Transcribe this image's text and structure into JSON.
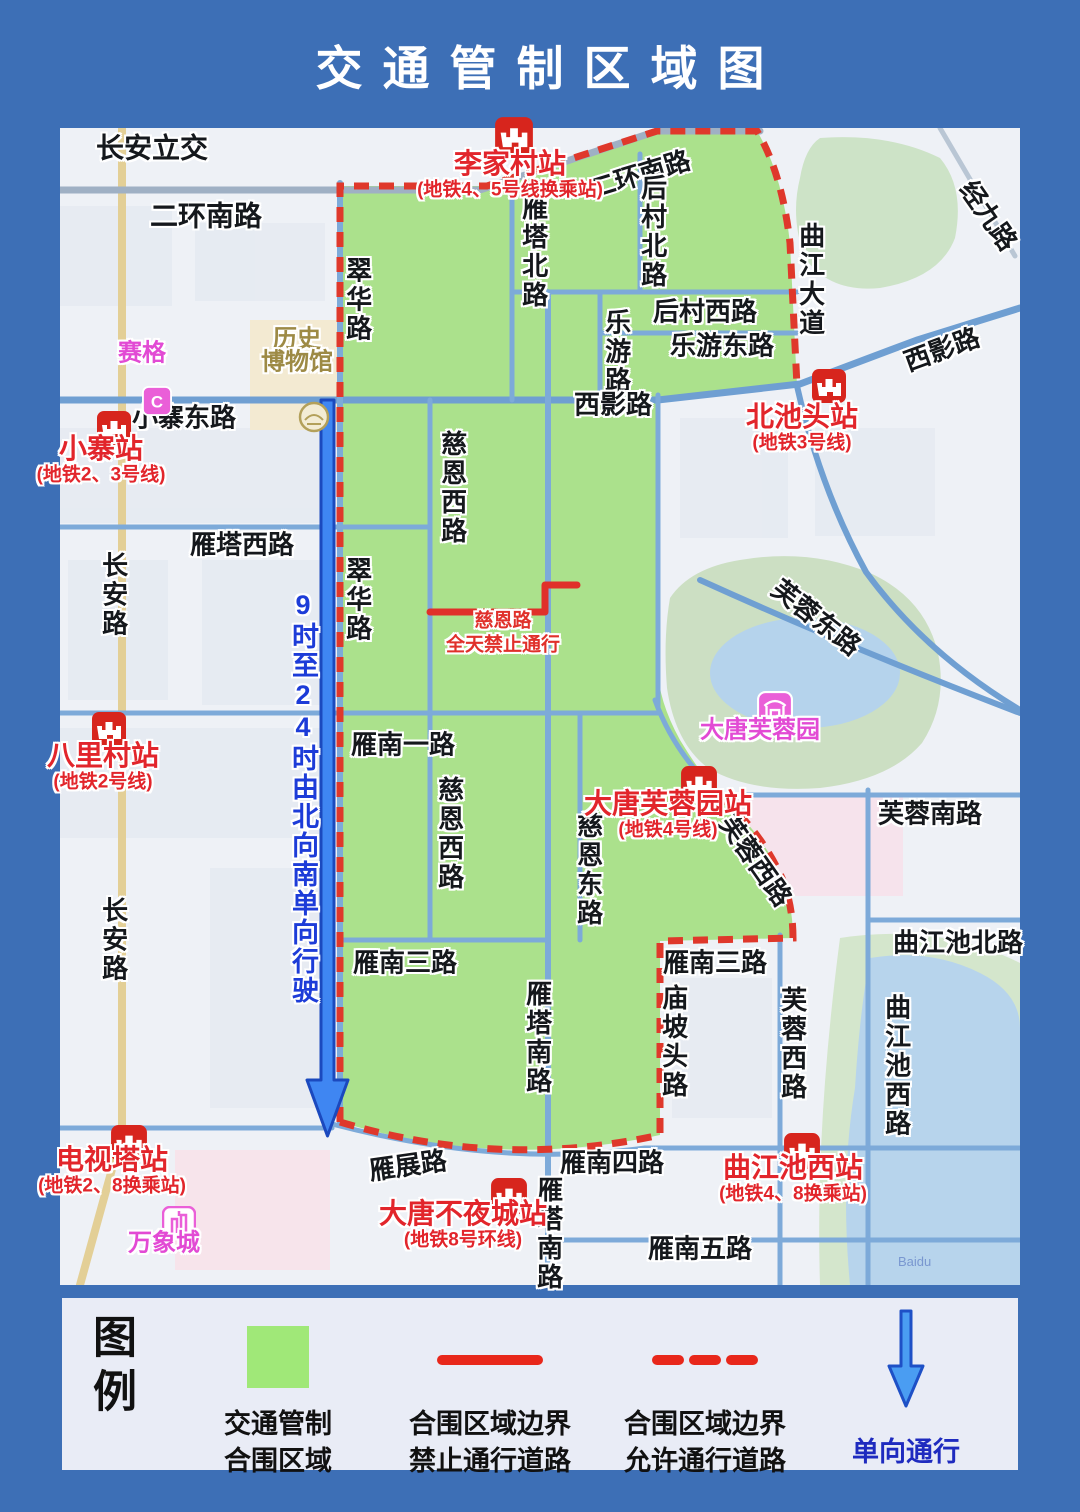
{
  "title": "交通管制区域图",
  "map": {
    "oneway_text": "9时至24时由北向南单向行驶",
    "restriction_note": {
      "line1": "慈恩路",
      "line2": "全天禁止通行"
    },
    "watermark": "Baidu",
    "road_labels": [
      {
        "text": "长安立交",
        "x": 92,
        "y": 20,
        "o": "h",
        "s": 28
      },
      {
        "text": "二环南路",
        "x": 146,
        "y": 88,
        "o": "h",
        "s": 28
      },
      {
        "text": "二环南路",
        "x": 580,
        "y": 47,
        "o": "h",
        "r": -17
      },
      {
        "text": "经九路",
        "x": 928,
        "y": 88,
        "o": "h",
        "r": 55
      },
      {
        "text": "曲江大道",
        "x": 750,
        "y": 152,
        "o": "v"
      },
      {
        "text": "翠华路",
        "x": 297,
        "y": 172,
        "o": "v"
      },
      {
        "text": "雁塔北路",
        "x": 473,
        "y": 124,
        "o": "v"
      },
      {
        "text": "后村北路",
        "x": 592,
        "y": 104,
        "o": "v"
      },
      {
        "text": "后村西路",
        "x": 645,
        "y": 184,
        "o": "h"
      },
      {
        "text": "乐游路",
        "x": 556,
        "y": 224,
        "o": "v"
      },
      {
        "text": "乐游东路",
        "x": 662,
        "y": 218,
        "o": "h"
      },
      {
        "text": "西影路",
        "x": 553,
        "y": 277,
        "o": "h"
      },
      {
        "text": "西影路",
        "x": 882,
        "y": 222,
        "o": "h",
        "r": -20
      },
      {
        "text": "小寨东路",
        "x": 124,
        "y": 290,
        "o": "h"
      },
      {
        "text": "慈恩西路",
        "x": 392,
        "y": 360,
        "o": "v"
      },
      {
        "text": "雁塔西路",
        "x": 182,
        "y": 417,
        "o": "h"
      },
      {
        "text": "长安路",
        "x": 53,
        "y": 467,
        "o": "v"
      },
      {
        "text": "翠华路",
        "x": 297,
        "y": 472,
        "o": "v"
      },
      {
        "text": "芙蓉东路",
        "x": 756,
        "y": 490,
        "o": "h",
        "r": 38
      },
      {
        "text": "雁南一路",
        "x": 343,
        "y": 617,
        "o": "h"
      },
      {
        "text": "慈恩西路",
        "x": 389,
        "y": 706,
        "o": "v"
      },
      {
        "text": "慈恩东路",
        "x": 528,
        "y": 742,
        "o": "v"
      },
      {
        "text": "芙蓉西路",
        "x": 695,
        "y": 733,
        "o": "h",
        "r": 55
      },
      {
        "text": "芙蓉南路",
        "x": 870,
        "y": 686,
        "o": "h"
      },
      {
        "text": "长安路",
        "x": 53,
        "y": 812,
        "o": "v"
      },
      {
        "text": "曲江池北路",
        "x": 898,
        "y": 815,
        "o": "h"
      },
      {
        "text": "雁南三路",
        "x": 345,
        "y": 835,
        "o": "h"
      },
      {
        "text": "雁南三路",
        "x": 655,
        "y": 835,
        "o": "h"
      },
      {
        "text": "庙坡头路",
        "x": 613,
        "y": 914,
        "o": "v"
      },
      {
        "text": "雁塔南路",
        "x": 477,
        "y": 910,
        "o": "v"
      },
      {
        "text": "芙蓉西路",
        "x": 732,
        "y": 916,
        "o": "v"
      },
      {
        "text": "曲江池西路",
        "x": 836,
        "y": 938,
        "o": "v"
      },
      {
        "text": "雁展路",
        "x": 348,
        "y": 1038,
        "o": "h",
        "r": -8
      },
      {
        "text": "雁南四路",
        "x": 552,
        "y": 1035,
        "o": "h"
      },
      {
        "text": "雁塔南路",
        "x": 488,
        "y": 1106,
        "o": "v"
      },
      {
        "text": "雁南五路",
        "x": 640,
        "y": 1121,
        "o": "h"
      }
    ],
    "stations": [
      {
        "name": "李家村站",
        "sub": "(地铁4、5号线换乘站)",
        "x": 450,
        "y": 34,
        "ix": 434,
        "iy": -12,
        "is": 40
      },
      {
        "name": "小寨站",
        "sub": "(地铁2、3号线)",
        "x": 41,
        "y": 319,
        "ix": 36,
        "iy": 282,
        "is": 36
      },
      {
        "name": "北池头站",
        "sub": "(地铁3号线)",
        "x": 742,
        "y": 287,
        "ix": 751,
        "iy": 240,
        "is": 36
      },
      {
        "name": "八里村站",
        "sub": "(地铁2号线)",
        "x": 43,
        "y": 626,
        "ix": 31,
        "iy": 583,
        "is": 36
      },
      {
        "name": "大唐芙蓉园站",
        "sub": "(地铁4号线)",
        "x": 608,
        "y": 674,
        "ix": 620,
        "iy": 637,
        "is": 38
      },
      {
        "name": "电视塔站",
        "sub": "(地铁2、8换乘站)",
        "x": 52,
        "y": 1030,
        "ix": 50,
        "iy": 996,
        "is": 38
      },
      {
        "name": "大唐不夜城站",
        "sub": "(地铁8号环线)",
        "x": 403,
        "y": 1084,
        "ix": 430,
        "iy": 1049,
        "is": 38
      },
      {
        "name": "曲江池西站",
        "sub": "(地铁4、8换乘站)",
        "x": 733,
        "y": 1038,
        "ix": 723,
        "iy": 1004,
        "is": 38
      }
    ],
    "pois": [
      {
        "icon": "saige-icon",
        "lines": [
          "赛格"
        ],
        "x": 82,
        "y": 222,
        "ix": 82,
        "iy": 258,
        "is": 30,
        "color": "#e24ad4"
      },
      {
        "icon": "museum-emblem-icon",
        "lines": [
          "历史",
          "博物馆"
        ],
        "x": 237,
        "y": 208,
        "ix": 237,
        "iy": 272,
        "is": 34,
        "color": "#9d8a45"
      },
      {
        "icon": "furong-garden-icon",
        "lines": [
          "大唐芙蓉园"
        ],
        "x": 700,
        "y": 599,
        "ix": 697,
        "iy": 563,
        "is": 36,
        "color": "#e24ad4"
      },
      {
        "icon": "mixc-towers-icon",
        "lines": [
          "万象城"
        ],
        "x": 104,
        "y": 1112,
        "ix": 102,
        "iy": 1078,
        "is": 34,
        "color": "#e24ad4"
      }
    ]
  },
  "legend": {
    "heading": "图例",
    "items": [
      {
        "line1": "交通管制",
        "line2": "合围区域"
      },
      {
        "line1": "合围区域边界",
        "line2": "禁止通行道路"
      },
      {
        "line1": "合围区域边界",
        "line2": "允许通行道路"
      },
      {
        "line1": "单向通行",
        "line2": ""
      }
    ]
  },
  "colors": {
    "background_blue": "#3d6fb6",
    "restricted_zone_green": "#abe18c",
    "boundary_red": "#df382b",
    "closed_road_red": "#e0302a",
    "road_blue": "#7daad9",
    "oneway_arrow_blue": "#3f86f2",
    "oneway_text_blue": "#1d3cd8",
    "station_red": "#e2252b",
    "poi_pink": "#e24ad4",
    "legend_text_navy": "#1f2bbf"
  }
}
